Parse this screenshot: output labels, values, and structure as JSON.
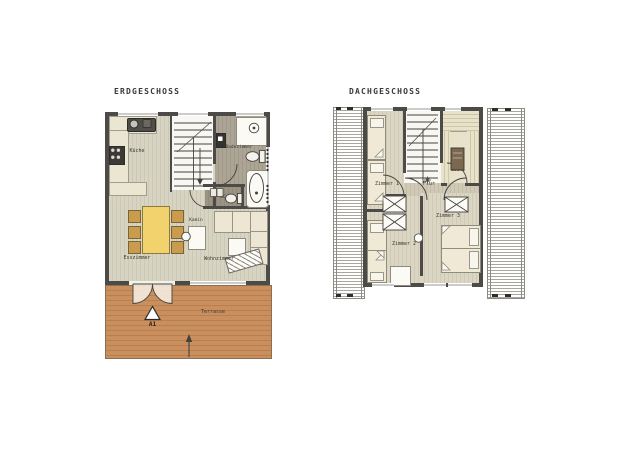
{
  "colors": {
    "wall": "#4d4b47",
    "floor_wood_stripe": "#d8d4c3",
    "terrace_wood": "#c98f5e",
    "bath_tile": "#aca495",
    "furniture_cream": "#ece6d2",
    "dining_table_yellow": "#f2d26d",
    "chair_tan": "#c89b4f",
    "sauna_heater_brown": "#7a6950",
    "roof_hatch_line": "#a8a59d"
  },
  "erdgeschoss": {
    "title": "ERDGESCHOSS",
    "labels": {
      "kueche": "Küche",
      "badezimmer": "Badezimmer",
      "wc": "WC",
      "kamin": "Kamin",
      "esszimmer": "Esszimmer",
      "wohnzimmer": "Wohnzimmer",
      "terrasse": "Terrasse",
      "marker_a1": "A1"
    }
  },
  "dachgeschoss": {
    "title": "DACHGESCHOSS",
    "labels": {
      "zimmer1": "Zimmer 1",
      "zimmer2": "Zimmer 2",
      "zimmer3": "Zimmer 3",
      "flur": "Flur",
      "sauna": "Sauna"
    }
  }
}
